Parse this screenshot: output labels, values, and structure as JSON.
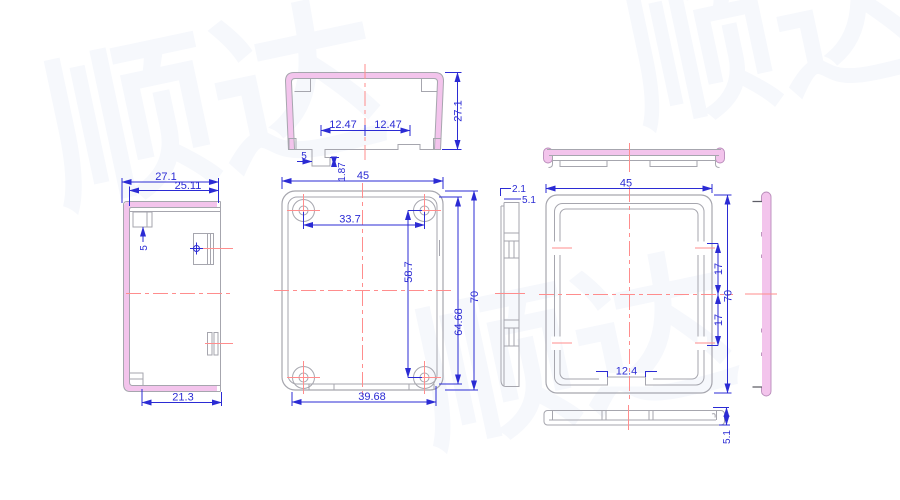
{
  "title": "enclosure-technical-drawing",
  "colors": {
    "dimension": "#2b2bd4",
    "outline": "#a6a6ae",
    "highlight_fill": "#f3c4ec",
    "highlight_stroke": "#b98cba",
    "centerline": "#ff8d8d",
    "background": "#ffffff",
    "watermark": "#f6f8fc"
  },
  "watermark": {
    "text": "顺达"
  },
  "views": {
    "top_section": {
      "label": "top cross-section view",
      "dims": {
        "height": "27.1",
        "tab_left": "12.47",
        "tab_right": "12.47",
        "tab_width": "5",
        "tab_depth": "1.87"
      }
    },
    "left_side": {
      "label": "left side view",
      "dims": {
        "depth": "27.1",
        "inner_depth": "25.11",
        "boss": "5",
        "bottom_width": "21.3"
      }
    },
    "base_front": {
      "label": "base front view",
      "dims": {
        "width": "45",
        "hole_pitch_x": "33.7",
        "hole_pitch_y": "58.7",
        "inner_height": "64.68",
        "height": "70",
        "inner_width": "39.68"
      }
    },
    "base_side": {
      "label": "base side profile",
      "dims": {
        "wall": "2.1",
        "depth": "5.1"
      }
    },
    "lid_top_profile": {
      "label": "lid top profile"
    },
    "lid_front": {
      "label": "lid front view",
      "dims": {
        "width": "45",
        "slot_top": "17",
        "height": "70",
        "slot_bottom": "17",
        "notch": "12.4"
      }
    },
    "lid_side": {
      "label": "lid side view"
    },
    "lid_bottom_profile": {
      "label": "lid bottom profile",
      "dims": {
        "depth": "5.1"
      }
    }
  }
}
